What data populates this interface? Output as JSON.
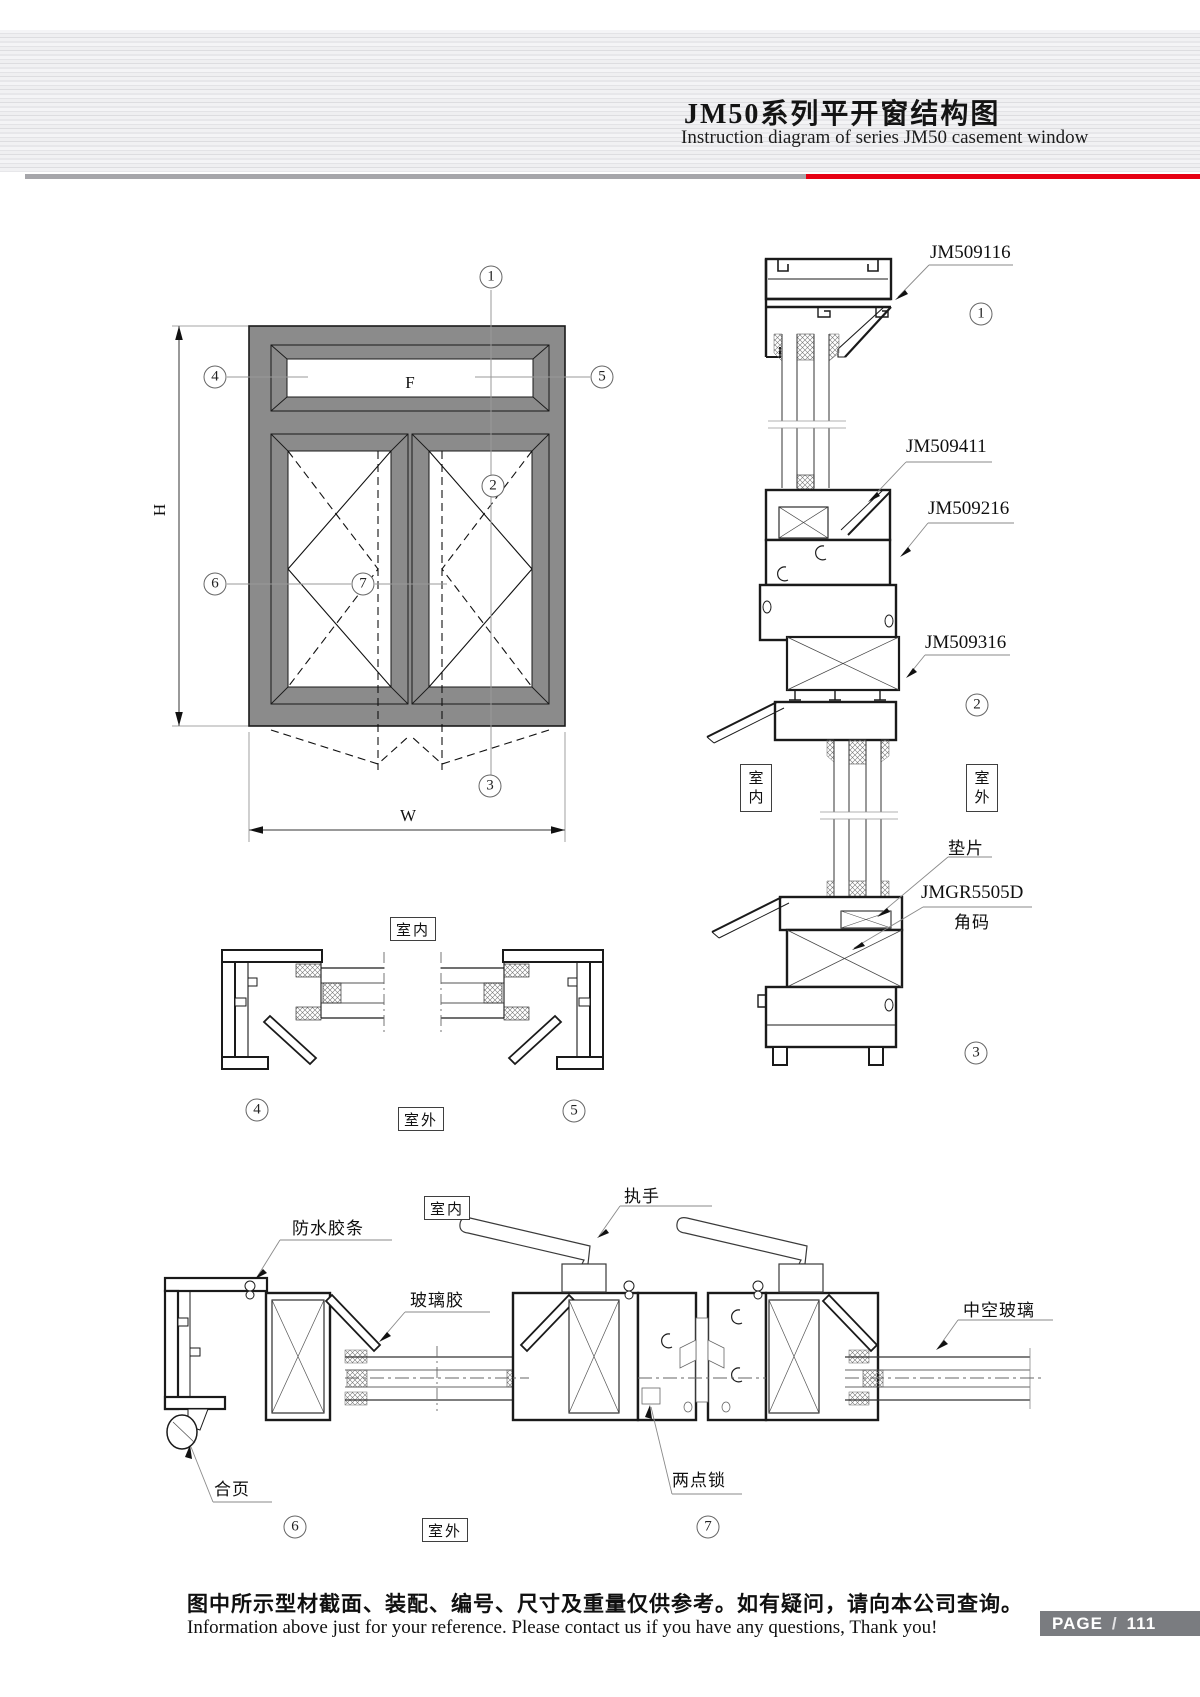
{
  "header": {
    "title_zh": "JM50系列平开窗结构图",
    "title_en": "Instruction diagram of series JM50 casement window"
  },
  "labels": {
    "indoor": "室内",
    "outdoor": "室外",
    "fixed_pane": "F",
    "height_dim": "H",
    "width_dim": "W"
  },
  "callouts": {
    "1": "1",
    "2": "2",
    "3": "3",
    "4": "4",
    "5": "5",
    "6": "6",
    "7": "7"
  },
  "vertical_section": {
    "profiles": [
      "JM509116",
      "JM509411",
      "JM509216",
      "JM509316"
    ],
    "shim": "垫片",
    "corner_code_no": "JMGR5505D",
    "corner_code": "角码"
  },
  "bottom_section": {
    "waterproof_strip": "防水胶条",
    "glass_glue": "玻璃胶",
    "handle": "执手",
    "insulating_glass": "中空玻璃",
    "hinge": "合页",
    "two_point_lock": "两点锁"
  },
  "footer": {
    "note_zh": "图中所示型材截面、装配、编号、尺寸及重量仅供参考。如有疑问，请向本公司查询。",
    "note_en": "Information above just for your reference. Please contact us if you have any questions, Thank you!",
    "page_label": "PAGE",
    "page_sep": "/",
    "page_number": "111"
  }
}
